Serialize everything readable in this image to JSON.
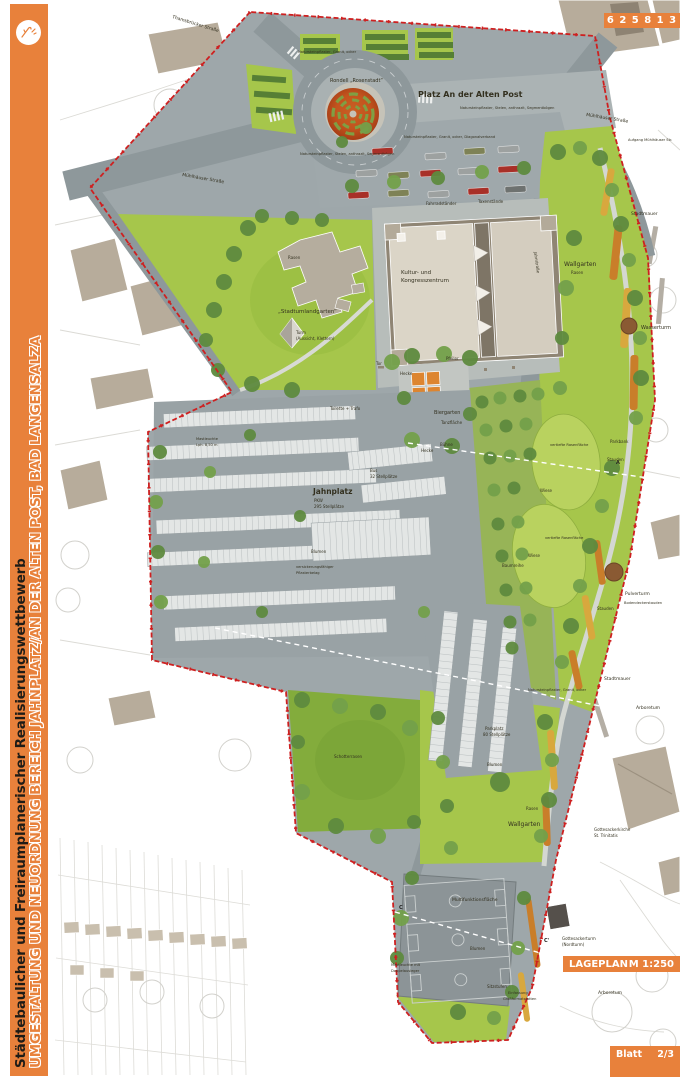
{
  "sidebar": {
    "line1": "Städtebaulicher und Freiraumplanerischer Realisierungswettbewerb",
    "line2": "UMGESTALTUNG UND NEUORDNUNG BEREICH JAHNPLATZ/AN DER ALTEN POST, BAD LANGENSALZA"
  },
  "header": {
    "code": "6 2 5 8 1 3"
  },
  "titleblock": {
    "plan_title": "LAGEPLAN",
    "scale": "M 1:250",
    "sheet_label": "Blatt",
    "sheet_number": "2/3"
  },
  "colors": {
    "accent": "#E8813B",
    "boundary": "#CE2020",
    "lawn": "#A6C64B",
    "asphalt": "#9EA7AA",
    "building": "#B7AC9B"
  },
  "streets": {
    "thamsbruecker": "Thamsbrücker Straße",
    "muehlhaeuser_west": "Mühlhäuser Straße",
    "muehlhaeuser_ost": "Mühlhäuser Straße",
    "jahnstrasse": "Jahnstraße",
    "aufgang": "Aufgang Mühlhäuser Str."
  },
  "places": {
    "platz": "Platz An der Alten Post",
    "rondell": "Rondell „Rosenstadt“",
    "kultur_l1": "Kultur- und",
    "kultur_l2": "Kongresszentrum",
    "stadtumlandgarten": "„Stadtumlandgarten“",
    "turm_l1": "Turm",
    "turm_l2": "(Aussicht, Klettern)",
    "biergarten": "Biergarten",
    "tanzflaeche": "Tanzfläche",
    "buehne": "Bühne",
    "jahnplatz": "Jahnplatz",
    "jahnplatz_sub1": "PKW",
    "jahnplatz_sub2": "295 Stellplätze",
    "bus": "Bus",
    "bus_sub": "32 Stellplätze",
    "wallgarten": "Wallgarten",
    "multifunktion": "Multifunktionsfläche",
    "wasserturm": "Wasserturm",
    "pulverturm": "Pulverturm",
    "stadtmauer": "Stadtmauer",
    "arboretum": "Arboretum",
    "kirche_l1": "Gottesackerkirche",
    "kirche_l2": "St. Trinitatis",
    "nordturm_l1": "Gottesackerturm",
    "nordturm_l2": "(Nordturm)"
  },
  "ann": {
    "rasen": "Rasen",
    "wiese": "Wiese",
    "blumen": "Blumen",
    "stauden": "Stauden",
    "bodendecker": "Bodendeckerstauden",
    "hecke": "Hecke",
    "parkbank": "Parkbank",
    "baumreihe": "Baumreihe",
    "vertieft": "vertiefte Rasenfläche",
    "fahrrad": "Fahrradständer",
    "taxi": "Taxenstände",
    "toilette": "Toilette + Trafo",
    "pflaster_ocker": "Natursteinpflaster, Granit, ocker",
    "pflaster_stelen": "Natursteinpflaster, Stelen, anthrazit, Segmentbögen",
    "pflaster_diag": "Natursteinpflaster, Granit, ocker, Diagonalverband",
    "versick_l1": "versickerungsfähiger",
    "versick_l2": "Pflasterbelag",
    "mast_l1": "Mastleuchte",
    "mast_l2": "Lph. 8,50 m",
    "mast2_l1": "Mastleuchte mit",
    "mast2_l2": "Doppelausleger",
    "sitzstufen": "Sitzstufen",
    "einf_l1": "Einfassung",
    "einf_l2": "Großformatplatten",
    "parkplatz_l1": "Parkplatz",
    "parkplatz_l2": "80 Stellplätze",
    "schotter": "Schotterrasen",
    "tor": "Tor",
    "pfeiler": "Pfeiler"
  },
  "marks": {
    "a": "A",
    "c": "C",
    "c2": "C'"
  }
}
